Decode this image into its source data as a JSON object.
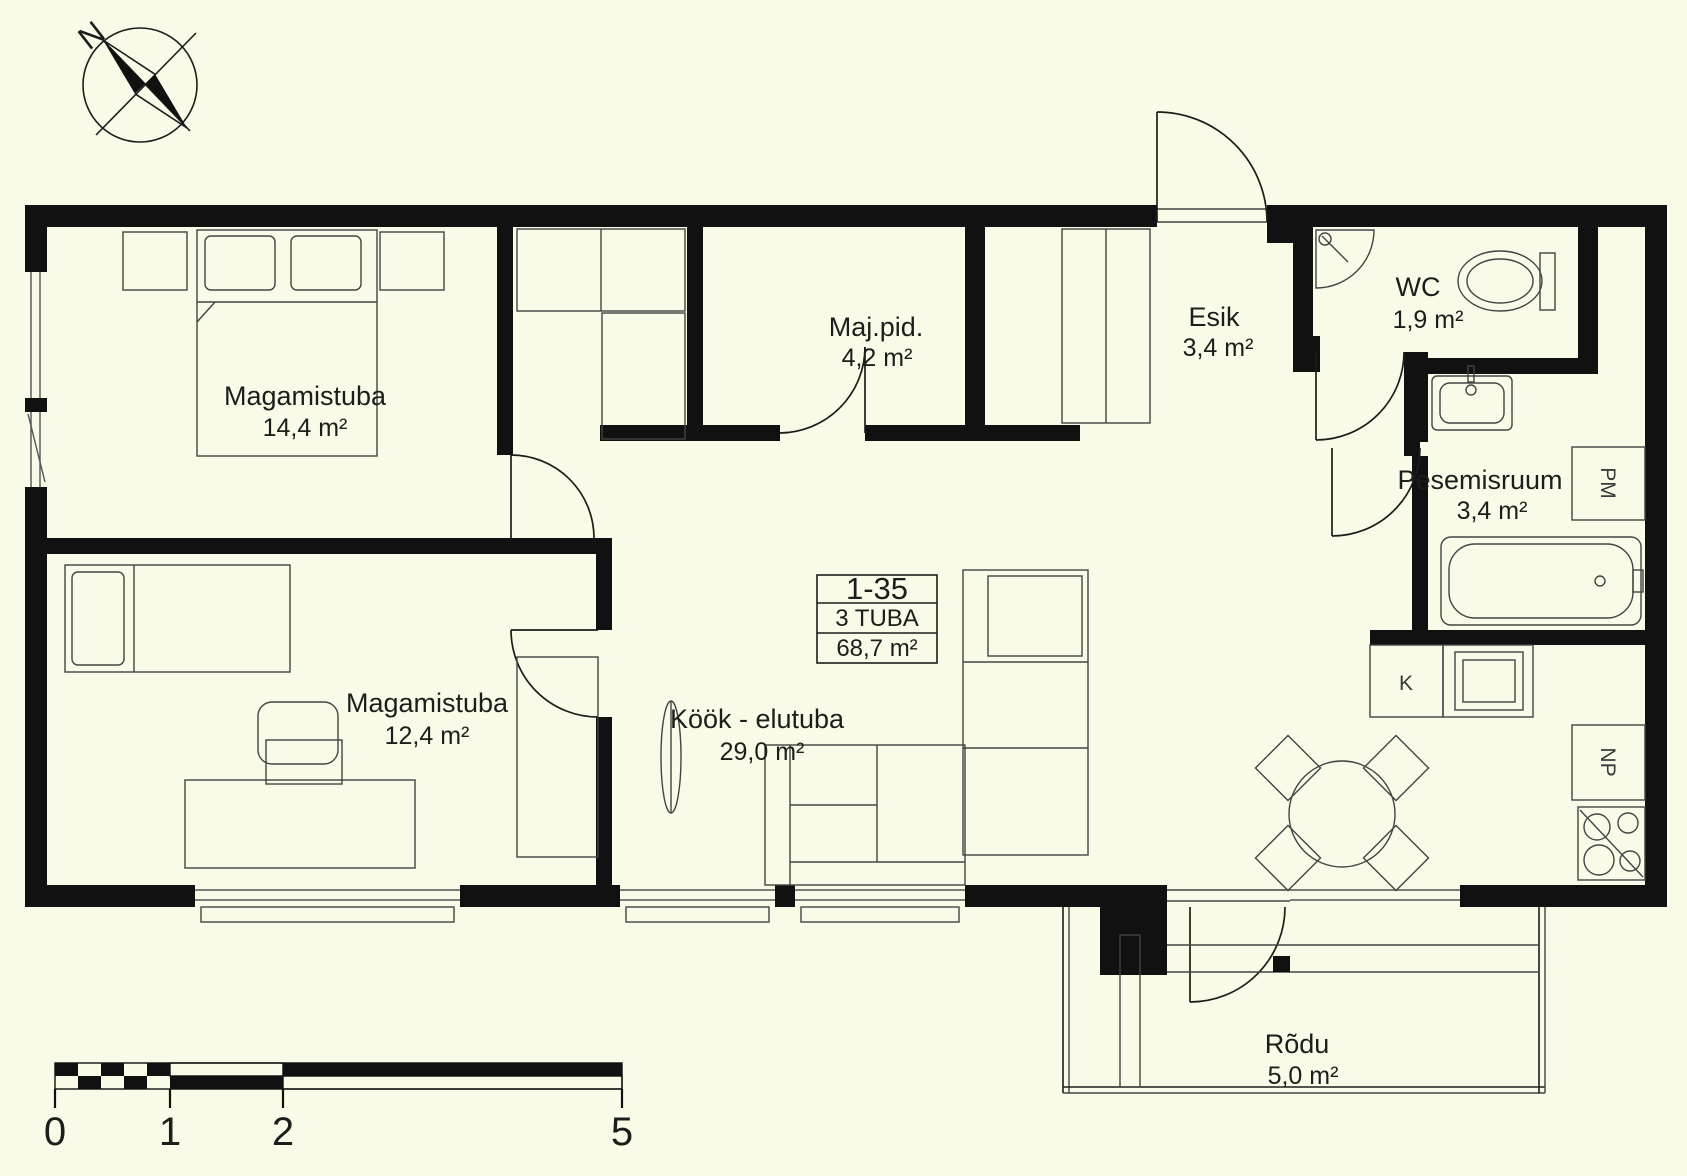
{
  "background_color": "#F9FAE7",
  "line_color": "#1D1D1B",
  "compass": {
    "north_label": "N"
  },
  "unit_box": {
    "number": "1-35",
    "type": "3 TUBA",
    "total_area": "68,7 m²"
  },
  "rooms": {
    "bedroom1": {
      "name": "Magamistuba",
      "area": "14,4 m²"
    },
    "bedroom2": {
      "name": "Magamistuba",
      "area": "12,4 m²"
    },
    "utility": {
      "name": "Maj.pid.",
      "area": "4,2 m²"
    },
    "hallway": {
      "name": "Esik",
      "area": "3,4 m²"
    },
    "wc": {
      "name": "WC",
      "area": "1,9 m²"
    },
    "washroom": {
      "name": "Pesemisruum",
      "area": "3,4 m²"
    },
    "kitchen_living": {
      "name": "Köök - elutuba",
      "area": "29,0 m²"
    },
    "balcony": {
      "name": "Rõdu",
      "area": "5,0 m²"
    }
  },
  "appliance_labels": {
    "washing_machine": "PM",
    "kitchen_sink": "K",
    "fridge": "NP"
  },
  "scale_bar": {
    "tick_labels": [
      "0",
      "1",
      "2",
      "5"
    ]
  }
}
